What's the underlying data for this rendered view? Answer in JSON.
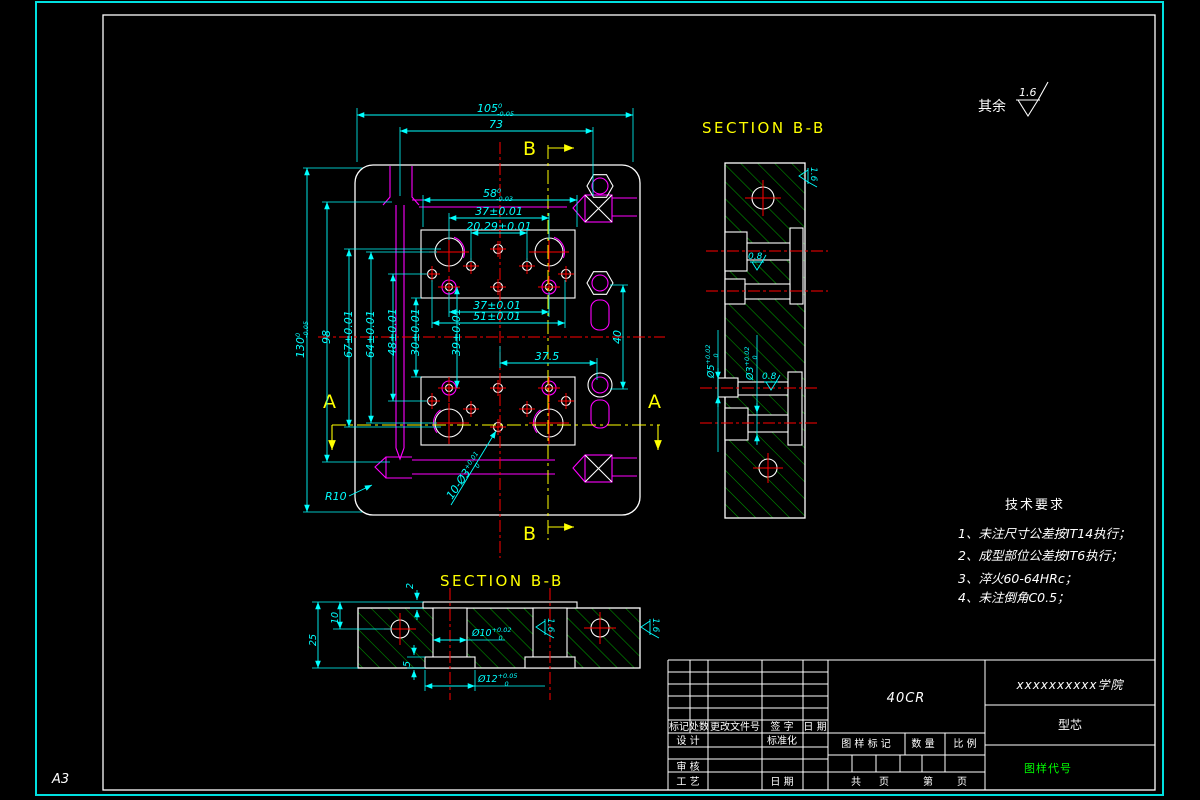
{
  "sheet": {
    "format": "A3"
  },
  "colors": {
    "background": "#000000",
    "outline": "#ffffff",
    "dimension": "#00ffff",
    "centerline": "#ff0000",
    "section_mark": "#ffff00",
    "feature": "#ff00ff",
    "hatch": "#00a000",
    "code_text": "#00ff00",
    "border": "#00e0e0"
  },
  "general_finish": {
    "prefix": "其余",
    "value": "1.6"
  },
  "sections": {
    "top_label": "SECTION  B-B",
    "bottom_label": "SECTION  B-B",
    "a": "A",
    "b": "B"
  },
  "plan_dims": {
    "d105": {
      "v": "105",
      "sup": "0",
      "sub": "-0.05"
    },
    "d73": "73",
    "d58": {
      "v": "58",
      "sup": "0",
      "sub": "-0.03"
    },
    "d37top": "37±0.01",
    "d2029": "20.29±0.01",
    "d130": {
      "v": "130",
      "sup": "0",
      "sub": "-0.05"
    },
    "d98": "98",
    "d67": "67±0.01",
    "d64": "64±0.01",
    "d48": "48±0.01",
    "d30": "30±0.01",
    "d39": "39±0.01",
    "d37mid": "37±0.01",
    "d51": "51±0.01",
    "d375": "37.5",
    "d40": "40",
    "r10": "R10",
    "holes": {
      "v": "10-Ø3",
      "sup": "+0.01",
      "sub": "0"
    }
  },
  "right_section_dims": {
    "dia5": {
      "v": "Ø5",
      "sup": "+0.02",
      "sub": "0"
    },
    "dia3": {
      "v": "Ø3",
      "sup": "+0.02",
      "sub": "0"
    },
    "finish_top": "1.6",
    "finish_mid": "0.8",
    "finish_low": "0.8"
  },
  "bottom_section_dims": {
    "d25": "25",
    "d10": "10",
    "d2": "2",
    "d5": "5",
    "dia10": {
      "v": "Ø10",
      "sup": "+0.02",
      "sub": "0"
    },
    "dia12": {
      "v": "Ø12",
      "sup": "+0.05",
      "sub": "0"
    },
    "finish_a": "1.6",
    "finish_b": "1.6"
  },
  "tech_req": {
    "title": "技术要求",
    "items": [
      "1、未注尺寸公差按IT14执行；",
      "2、成型部位公差按IT6执行；",
      "3、淬火60-64HRc；",
      "4、未注倒角C0.5；"
    ]
  },
  "title_block": {
    "material": "40CR",
    "company": "xxxxxxxxxx学院",
    "part_name": "型芯",
    "drawing_code": "图样代号",
    "rev_headers": [
      "标记",
      "处数",
      "更改文件号",
      "签 字",
      "日 期"
    ],
    "row_design": "设 计",
    "row_standard": "标准化",
    "row_check": "审 核",
    "row_process": "工 艺",
    "row_date": "日 期",
    "mark_label": "图 样 标 记",
    "qty_label": "数 量",
    "scale_label": "比 例",
    "total_label": "共",
    "page_label": "页",
    "sheet_label": "第",
    "page2_label": "页"
  }
}
